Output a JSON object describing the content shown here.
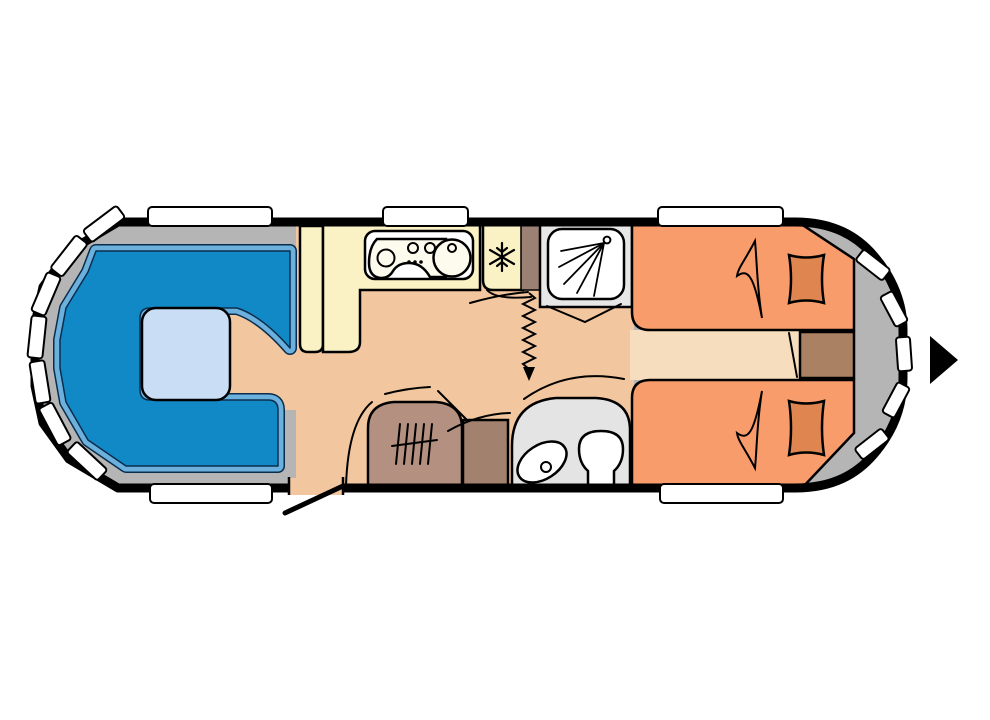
{
  "figure": {
    "type": "caravan-floorplan-diagram"
  },
  "colors": {
    "outline": "#000000",
    "wall_gray": "#b5b5b5",
    "floor": "#f2c79f",
    "aisle": "#f6ddbd",
    "seat": "#1289c7",
    "seat_edge": "#6cb0dd",
    "seat_line": "#0a2d4d",
    "table": "#c9def5",
    "kitchen": "#faf2c4",
    "white": "#ffffff",
    "divider": "#9b8173",
    "shower_room": "#e7e7e7",
    "bed": "#f89c6b",
    "pillow": "#df8550",
    "blanket": "#ef8d58",
    "bedside": "#ab8163",
    "wardrobe": "#b49080",
    "cabinet": "#a2826f",
    "washroom": "#e4e4e4",
    "arrow": "#000000"
  },
  "features": [
    "front-lounge-u-seating",
    "dinette-table",
    "kitchen-counter",
    "hob-and-sink-unit",
    "fridge",
    "curtain-divider",
    "shower-cubicle",
    "single-bed-top",
    "single-bed-bottom",
    "bedside-cabinet",
    "wardrobe",
    "cabinet",
    "washroom-with-basin-and-toilet",
    "entrance-door",
    "travel-direction-arrow",
    "windows"
  ]
}
